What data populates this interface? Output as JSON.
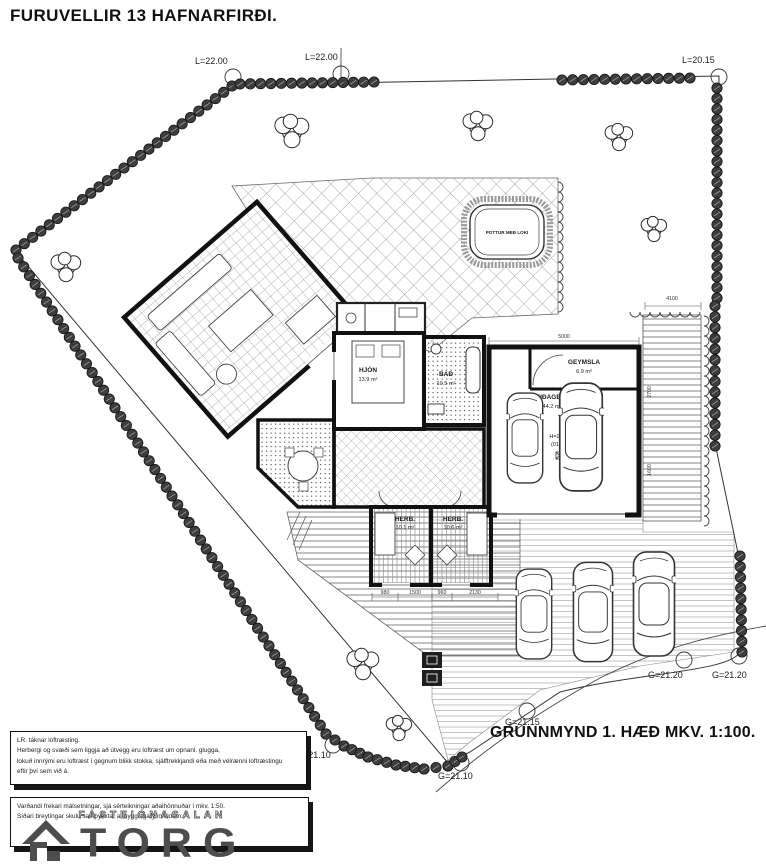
{
  "title": "FURUVELLIR 13 HAFNARFIRÐI.",
  "caption": "GRUNNMYND 1. HÆÐ  MKV. 1:100.",
  "levels": {
    "top_left": "L=22.00",
    "top_mid": "L=22.00",
    "top_right": "L=20.15",
    "right_a": "G=21.20",
    "right_b": "G=21.20",
    "street_a": "G=21.15",
    "street_b": "G=21.10",
    "street_c": "G=21.10"
  },
  "rooms": {
    "hjon_name": "HJÓN",
    "hjon_area": "13.9 m²",
    "bad_name": "BAÐ",
    "bad_area": "10.5 m²",
    "geymsla_name": "GEYMSLA",
    "geymsla_area": "6.9 m²",
    "garage_name": "BIFREIÐAGEYMSLA",
    "garage_area": "44.2 m²",
    "garage_height": "H=21.60",
    "garage_ref": "(01-02)",
    "herb1_name": "HERB.",
    "herb1_area": "10.1 m²",
    "herb2_name": "HERB.",
    "herb2_area": "10.6 m²",
    "pottur": "POTTUR MEÐ LOKI"
  },
  "dims": {
    "garage_w": "5000",
    "deck_w": "4100",
    "deck_h1": "2700",
    "deck_h2": "1600",
    "bed_a": "980",
    "bed_b": "1500",
    "bed_c": "960",
    "bed_d": "2130"
  },
  "notes": {
    "box1_line1": "LR. táknar loftræsting.",
    "box1_line2": "Herbergi og svæði sem liggja að útvegg eru loftræst um opnanl. glugga,",
    "box1_line3": "lokuð innrými eru loftræst í gegnum blikk stokka, sjálftrekkjandi eða með vélrænni loftræstingu",
    "box1_line4": "eftir því sem við á.",
    "box2_line1": "Varðandi frekari málsetningar, sjá sérteikningar aðalhönnuðar í mkv. 1:50.",
    "box2_line2": "Síðari breytingar skulu samþykktar af byggingaryfirvöldum.",
    "box2_watermark": "FASTEIGNASALAN"
  },
  "logo": {
    "text": "TORG"
  },
  "colors": {
    "ink": "#1c1c1c",
    "hedge": "#3d3d3d",
    "logo": "#4d4d4d"
  }
}
